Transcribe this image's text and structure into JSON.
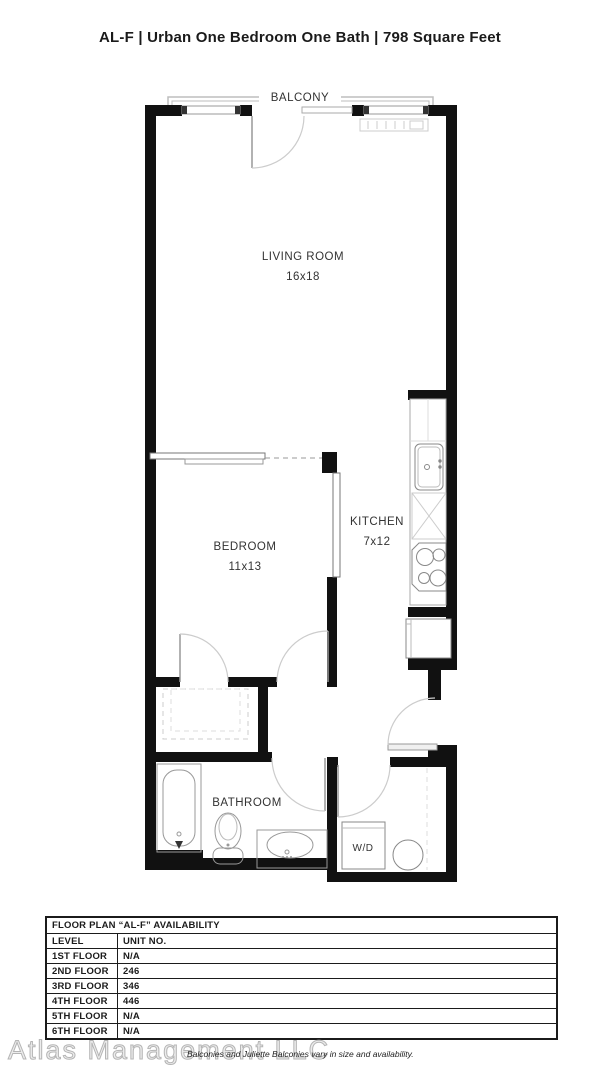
{
  "page": {
    "title": "AL-F | Urban One Bedroom One Bath | 798 Square Feet"
  },
  "floor_plan": {
    "balcony_label": "BALCONY",
    "living_room": {
      "label": "LIVING ROOM",
      "dimensions": "16x18"
    },
    "bedroom": {
      "label": "BEDROOM",
      "dimensions": "11x13"
    },
    "kitchen": {
      "label": "KITCHEN",
      "dimensions": "7x12"
    },
    "bathroom": {
      "label": "BATHROOM"
    },
    "washer_dryer_label": "W/D"
  },
  "availability": {
    "title": "FLOOR PLAN “AL-F” AVAILABILITY",
    "columns": [
      "LEVEL",
      "UNIT NO."
    ],
    "rows": [
      {
        "level": "1ST FLOOR",
        "unit": "N/A"
      },
      {
        "level": "2ND FLOOR",
        "unit": "246"
      },
      {
        "level": "3RD FLOOR",
        "unit": "346"
      },
      {
        "level": "4TH FLOOR",
        "unit": "446"
      },
      {
        "level": "5TH FLOOR",
        "unit": "N/A"
      },
      {
        "level": "6TH FLOOR",
        "unit": "N/A"
      }
    ]
  },
  "footer": {
    "watermark": "Atlas Management LLC",
    "disclaimer": "Balconies and Juliette Balconies vary in size and availability."
  },
  "colors": {
    "wall": "#111111",
    "fixture_line": "#999999",
    "light_line": "#cccccc"
  }
}
